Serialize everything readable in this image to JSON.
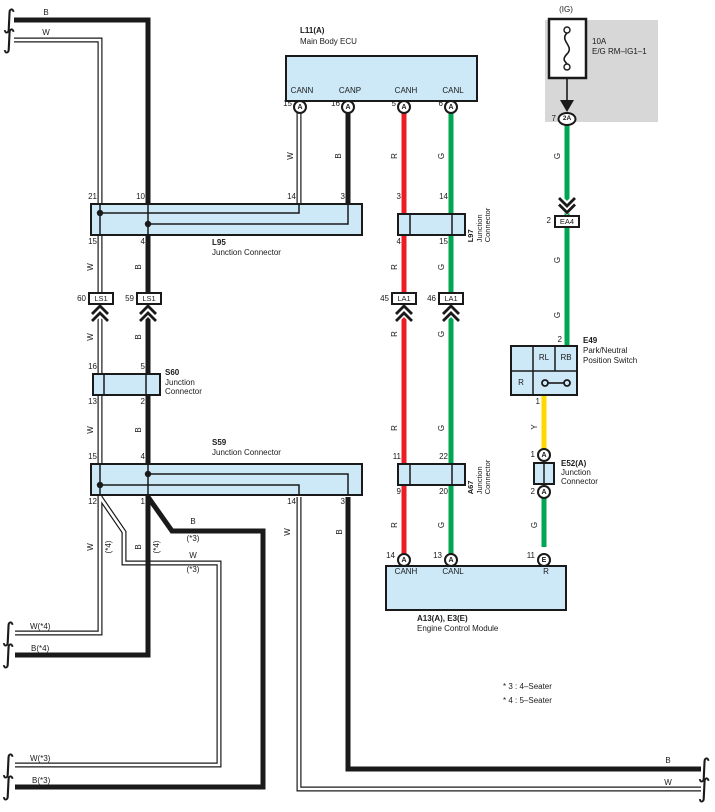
{
  "symbols": {
    "brace": "∫"
  },
  "colors": {
    "box_fill": "#cde9f8",
    "outline": "#1a1a1a",
    "red_wire": "#ec1b24",
    "green_wire": "#00a651",
    "yellow_wire": "#ffd800",
    "fuse_panel": "#d7d7d7"
  },
  "wire_labels": {
    "w": "W",
    "b": "B",
    "r": "R",
    "g": "G",
    "y": "Y",
    "star3": "(*3)",
    "star4": "(*4)",
    "w_star4": "W(*4)",
    "b_star4": "B(*4)",
    "w_star3": "W(*3)",
    "b_star3": "B(*3)"
  },
  "ecu": {
    "code": "L11(A)",
    "name": "Main Body ECU",
    "pins": [
      {
        "num": "15",
        "conn": "A",
        "name": "CANN"
      },
      {
        "num": "16",
        "conn": "A",
        "name": "CANP"
      },
      {
        "num": "5",
        "conn": "A",
        "name": "CANH"
      },
      {
        "num": "6",
        "conn": "A",
        "name": "CANL"
      }
    ]
  },
  "fuse": {
    "title": "(IG)",
    "rating": "10A",
    "name": "E/G RM–IG1–1",
    "pin": "7",
    "conn": "2A"
  },
  "l95": {
    "code": "L95",
    "name": "Junction Connector",
    "pins_top": [
      "21",
      "10",
      "14",
      "3"
    ],
    "pins_bottom": [
      "15",
      "4"
    ]
  },
  "l97": {
    "code": "L97",
    "name_lines": [
      "Junction",
      "Connector"
    ],
    "pins_top": [
      "3",
      "14"
    ],
    "pins_bottom": [
      "4",
      "15"
    ]
  },
  "ea4": {
    "pin": "2",
    "code": "EA4"
  },
  "ls1": {
    "code": "LS1",
    "pins": [
      "60",
      "59"
    ]
  },
  "la1": {
    "code": "LA1",
    "pins": [
      "45",
      "46"
    ]
  },
  "s60": {
    "code": "S60",
    "name_lines": [
      "Junction",
      "Connector"
    ],
    "pins_top": [
      "16",
      "5"
    ],
    "pins_bottom": [
      "13",
      "2"
    ]
  },
  "s59": {
    "code": "S59",
    "name": "Junction Connector",
    "pins_top": [
      "15",
      "4"
    ],
    "pins_bottom": [
      "12",
      "1",
      "14",
      "3"
    ]
  },
  "a67": {
    "code": "A67",
    "name_lines": [
      "Junction",
      "Connector"
    ],
    "pins_top": [
      "11",
      "22"
    ],
    "pins_bottom": [
      "9",
      "20"
    ]
  },
  "e49": {
    "code": "E49",
    "name_lines": [
      "Park/Neutral",
      "Position Switch"
    ],
    "cell_rl": "RL",
    "cell_rb": "RB",
    "cell_r": "R",
    "pin_top": "2",
    "pin_bottom": "1"
  },
  "e52": {
    "code": "E52(A)",
    "name_lines": [
      "Junction",
      "Connector"
    ],
    "pins": [
      {
        "num": "1",
        "conn": "A"
      },
      {
        "num": "2",
        "conn": "A"
      }
    ]
  },
  "ecm": {
    "code": "A13(A), E3(E)",
    "name": "Engine Control Module",
    "pins": [
      {
        "num": "14",
        "conn": "A",
        "name": "CANH"
      },
      {
        "num": "13",
        "conn": "A",
        "name": "CANL"
      },
      {
        "num": "11",
        "conn": "E",
        "name": "R"
      }
    ]
  },
  "notes": [
    "* 3 : 4–Seater",
    "* 4 : 5–Seater"
  ]
}
